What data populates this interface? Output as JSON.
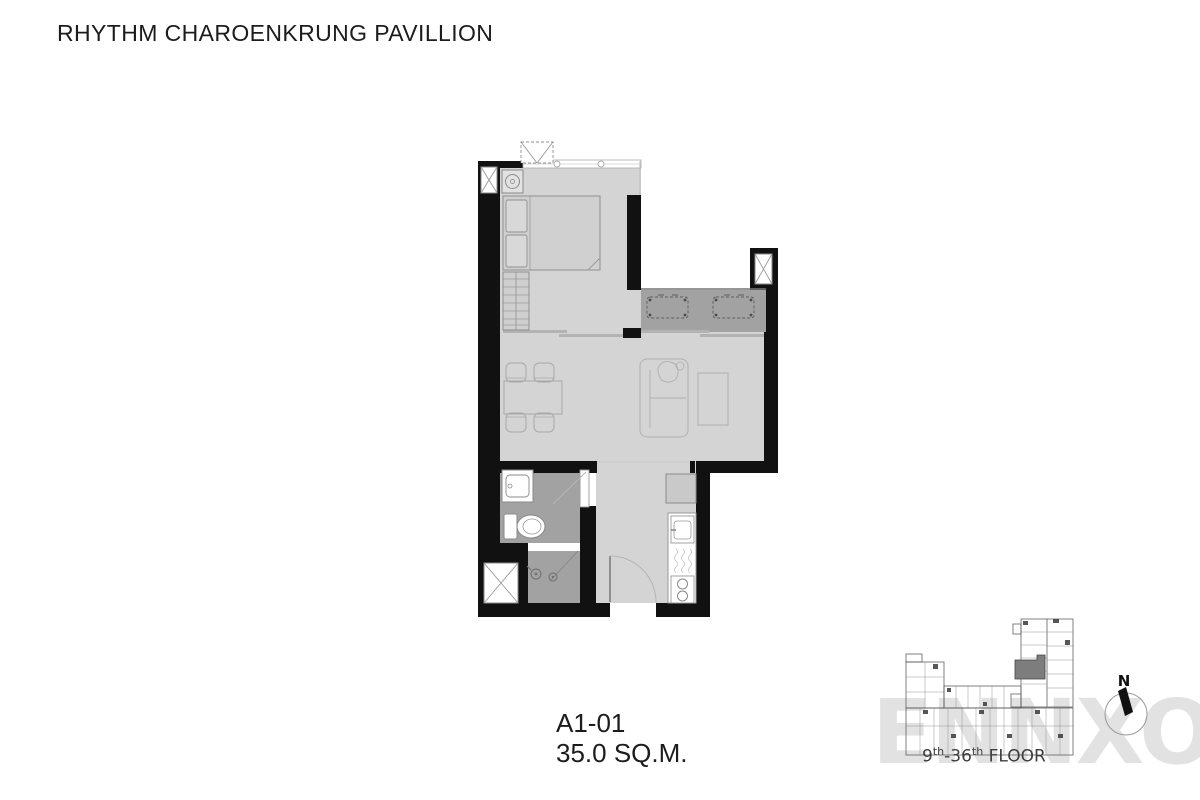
{
  "title": "RHYTHM CHAROENKRUNG PAVILLION",
  "unit": {
    "code": "A1-01",
    "area": "35.0 SQ.M."
  },
  "keyplan": {
    "floor_from": "9",
    "floor_from_sup": "th",
    "floor_to": "-36",
    "floor_to_sup": "th",
    "floor_word": " FLOOR",
    "north": "N"
  },
  "watermark": "ENNXO",
  "colors": {
    "wall": "#111111",
    "floor": "#d4d4d4",
    "wet": "#a2a2a2",
    "slider": "#b3b3b3",
    "strokeDark": "#8a8a8a",
    "strokeLight": "#aeaeae",
    "counter": "#ffffff",
    "fridge": "#c9c9c9",
    "keyline": "#555555",
    "highlight": "#7d7d7d",
    "watermark": "#e2e2e2",
    "text": "#1c1c1c",
    "subtext": "#3d3d3d"
  },
  "plan_icons": [
    "washing-machine-icon",
    "bed",
    "wardrobe",
    "dining-table",
    "dining-chairs",
    "sofa",
    "tv-console",
    "balcony-ac-unit",
    "shaft-x-icon",
    "outdoor-ac-icon",
    "bathroom-vanity",
    "toilet",
    "shower-head-icon",
    "floor-drain-icon",
    "refrigerator",
    "kitchen-sink",
    "stove-icon",
    "entrance-door-swing",
    "sliding-door",
    "window-band",
    "building-key-plan",
    "north-arrow"
  ]
}
